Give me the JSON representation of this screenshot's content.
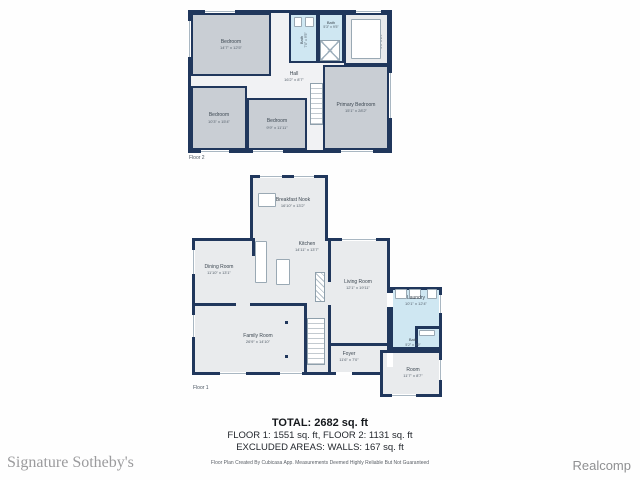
{
  "colors": {
    "wall": "#20375c",
    "room_gray": "#c9ced4",
    "room_blue": "#cfe7f2",
    "room_light": "#e9ebed"
  },
  "floor2": {
    "label": "Floor 2",
    "rooms": [
      {
        "name": "Bedroom",
        "dims": "14'7\" x 12'5\""
      },
      {
        "name": "Bath",
        "dims": "7'0\" x 9'5\""
      },
      {
        "name": "Bath",
        "dims": "5'3\" x 9'5\""
      },
      {
        "name": "WIC",
        "dims": "5'1\" x 8'9\""
      },
      {
        "name": "Hall",
        "dims": "16'2\" x 8'7\""
      },
      {
        "name": "Bedroom",
        "dims": "10'3\" x 15'4\""
      },
      {
        "name": "Bedroom",
        "dims": "9'9\" x 11'11\""
      },
      {
        "name": "Primary Bedroom",
        "dims": "15'1\" x 28'2\""
      }
    ]
  },
  "floor1": {
    "label": "Floor 1",
    "rooms": [
      {
        "name": "Breakfast Nook",
        "dims": "16'10\" x 13'2\""
      },
      {
        "name": "Kitchen",
        "dims": "14'11\" x 13'7\""
      },
      {
        "name": "Dining Room",
        "dims": "11'10\" x 13'1\""
      },
      {
        "name": "Living Room",
        "dims": "12'1\" x 19'11\""
      },
      {
        "name": "Laundry",
        "dims": "10'1\" x 12'4\""
      },
      {
        "name": "Family Room",
        "dims": "26'9\" x 14'10\""
      },
      {
        "name": "Foyer",
        "dims": "11'6\" x 7'0\""
      },
      {
        "name": "Bath",
        "dims": "5'2\" x 4'9\""
      },
      {
        "name": "Room",
        "dims": "11'7\" x 8'7\""
      }
    ]
  },
  "summary": {
    "total": "TOTAL: 2682 sq. ft",
    "floors": "FLOOR 1: 1551 sq. ft, FLOOR 2: 1131 sq. ft",
    "excluded": "EXCLUDED AREAS: WALLS: 167 sq. ft",
    "disclaimer": "Floor Plan Created By Cubicasa App. Measurements Deemed Highly Reliable But Not Guaranteed"
  },
  "branding": {
    "left_watermark": "Signature Sotheby's",
    "right_watermark": "Realcomp"
  }
}
